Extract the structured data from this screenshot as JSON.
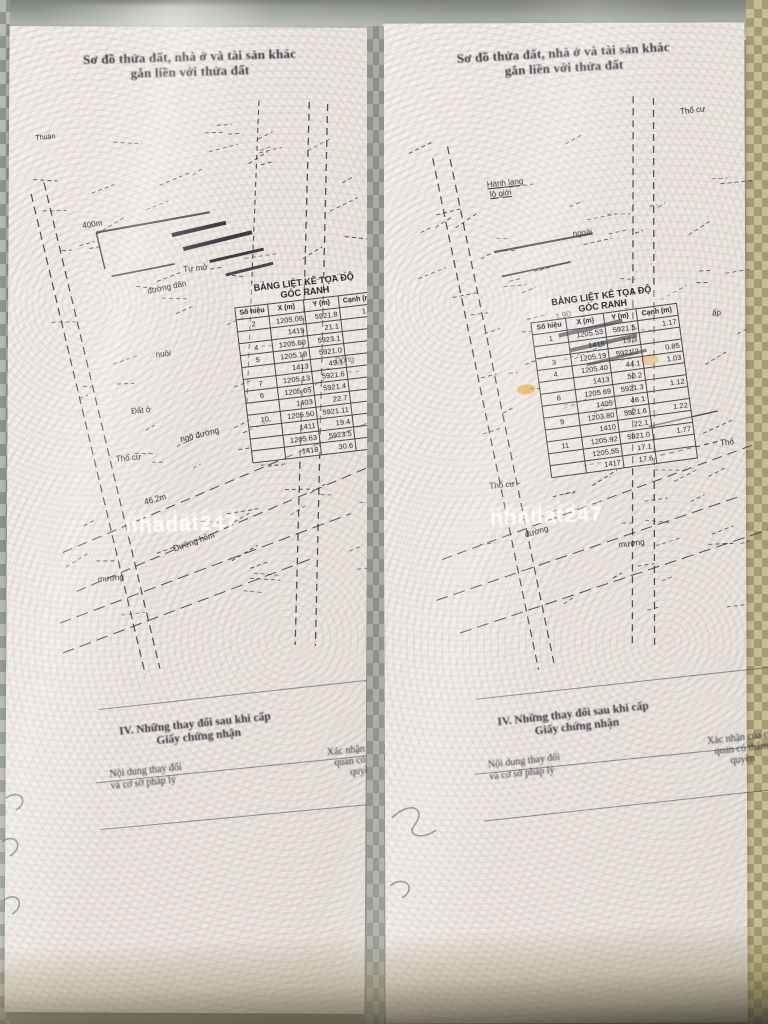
{
  "watermark": {
    "text": "nhadat247"
  },
  "footer": {
    "heading1": "IV. Những thay đổi sau khi cấp",
    "heading2": "Giấy chứng nhận",
    "col_left1": "Nội dung thay đổi",
    "col_left2": "và cơ sở pháp lý",
    "col_right1": "Xác nhận của cơ",
    "col_right2": "quan có thẩm",
    "col_right3": "quyền"
  },
  "pages": {
    "left": {
      "heading": {
        "line1": "Sơ đồ thửa đất, nhà ở và tài sản khác",
        "line2": "gắn liền với thửa đất"
      },
      "diagram_labels": [
        "Thuận",
        "400m",
        "Tự mở",
        "đường dân",
        "Đất ở",
        "nuôi",
        "Thổ cư",
        "ngõ đường",
        "Đường hẻm",
        "mương",
        "Đông",
        "46.2m"
      ],
      "coord_table": {
        "title1": "BẢNG LIỆT KÊ TỌA ĐỘ",
        "title2": "GÓC RANH",
        "columns": [
          "Số hiệu",
          "X (m)",
          "Y (m)",
          "Cạnh (m)"
        ],
        "rows": [
          [
            "2",
            "1205.08",
            "5921.8",
            "1.65"
          ],
          [
            "",
            "1419",
            "21.1",
            ""
          ],
          [
            "4",
            "1205.60",
            "5923.1",
            ""
          ],
          [
            "5",
            "1205.18",
            "5921.0",
            "7.89"
          ],
          [
            "",
            "1413",
            "49.1",
            ""
          ],
          [
            "7",
            "1205.13",
            "5921.6",
            "6.8"
          ],
          [
            "6",
            "1205.65",
            "5921.4",
            "1.81"
          ],
          [
            "",
            "1403",
            "22.7",
            ""
          ],
          [
            "10",
            "1205.50",
            "5921.11",
            "1.96"
          ],
          [
            "",
            "1411",
            "19.4",
            ""
          ],
          [
            "",
            "1205.63",
            "5923.5",
            ""
          ],
          [
            "",
            "1418",
            "30.6",
            ""
          ]
        ]
      }
    },
    "right": {
      "heading": {
        "line1": "Sơ đồ thửa đất, nhà ở và tài sản khác",
        "line2": "gắn liền với thửa đất"
      },
      "diagram_labels": [
        "Hành lang",
        "lộ giới",
        "Thổ cư",
        "ngoài",
        "1.90",
        "Thổ cư",
        "đường",
        "mương",
        "ấp",
        "Thổ"
      ],
      "coord_table": {
        "title1": "BẢNG LIỆT KÊ TỌA ĐỘ",
        "title2": "GÓC RANH",
        "columns": [
          "Số hiệu",
          "X (m)",
          "Y (m)",
          "Cạnh (m)"
        ],
        "rows": [
          [
            "1",
            "1205.53",
            "5921.5",
            "1.17"
          ],
          [
            "",
            "1415",
            "19.3",
            ""
          ],
          [
            "3",
            "1205.19",
            "5921.2",
            "0.85"
          ],
          [
            "4",
            "1205.40",
            "44.1",
            "1.03"
          ],
          [
            "",
            "1413",
            "50.2",
            ""
          ],
          [
            "6",
            "1205.69",
            "5921.3",
            "1.12"
          ],
          [
            "",
            "1405",
            "46.1",
            ""
          ],
          [
            "9",
            "1203.80",
            "5921.6",
            "1.22"
          ],
          [
            "",
            "1410",
            "22.1",
            ""
          ],
          [
            "11",
            "1205.92",
            "5921.0",
            "1.77"
          ],
          [
            "",
            "1205.55",
            "17.1",
            ""
          ],
          [
            "",
            "1417",
            "17.6",
            ""
          ]
        ]
      }
    }
  }
}
